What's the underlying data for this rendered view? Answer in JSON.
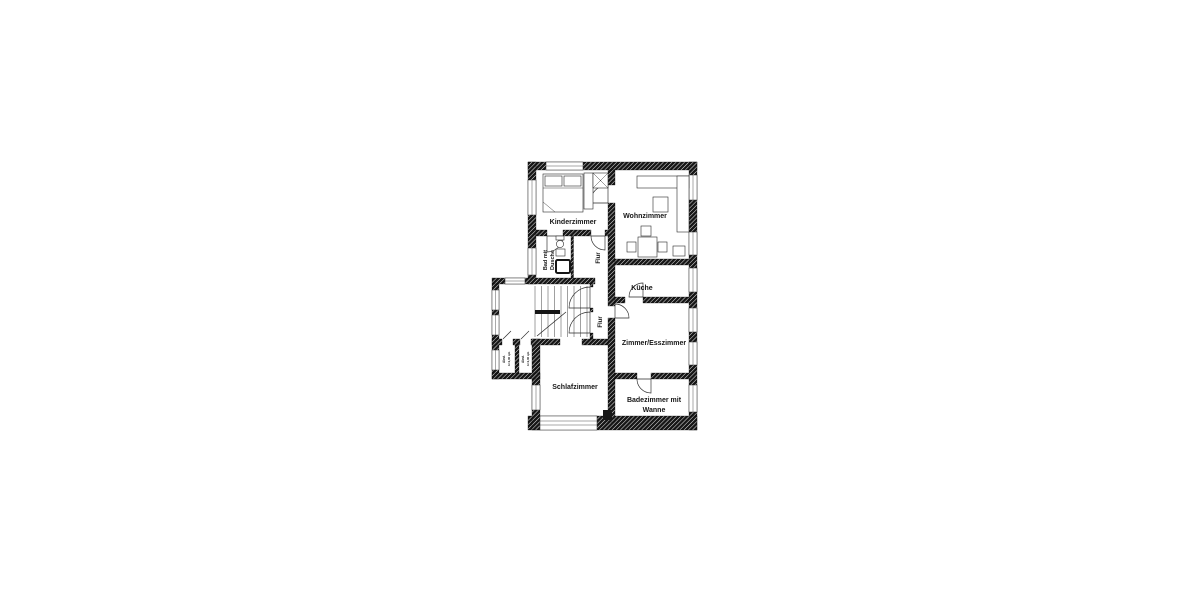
{
  "plan": {
    "type": "apartment-floor-plan",
    "colors": {
      "wall": "#161616",
      "paper": "#ffffff",
      "line": "#2a2a2a"
    },
    "rooms": {
      "kinderzimmer": {
        "label": "Kinderzimmer"
      },
      "wohnzimmer": {
        "label": "Wohnzimmer"
      },
      "bad": {
        "label_line1": "Bad mit",
        "label_line2": "Dusche"
      },
      "flur_upper": {
        "label": "Flur"
      },
      "kueche": {
        "label": "Küche"
      },
      "flur_lower": {
        "label": "Flur"
      },
      "zimmer_esszimmer": {
        "label": "Zimmer/Esszimmer"
      },
      "schlafzimmer": {
        "label": "Schlafzimmer"
      },
      "badezimmer": {
        "label_line1": "Badezimmer mit",
        "label_line2": "Wanne"
      },
      "abstellraum_1": {
        "label": "Abst.",
        "area": "A=1,40 qm"
      },
      "abstellraum_2": {
        "label": "Abst.",
        "area": "A=1,40 qm"
      }
    }
  }
}
